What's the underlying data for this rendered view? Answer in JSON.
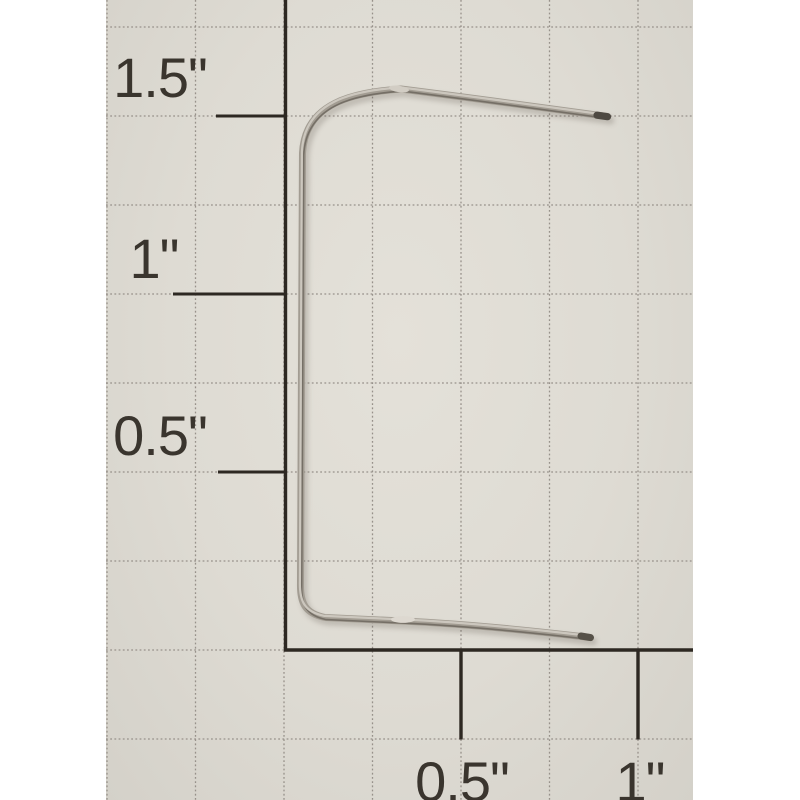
{
  "photo": {
    "subject": "metal-wire-clip",
    "paper_color": "#dedbd3",
    "grid_line_color": "#97918a",
    "axis_line_color": "#2d2822",
    "label_color": "#3a352e",
    "wire_body_color": "#a29c92",
    "wire_highlight_color": "#cdc8bf",
    "wire_tip_color": "#4e4942",
    "margin_color": "#ffffff"
  },
  "ruler": {
    "left_labels": [
      {
        "text": "1.5\""
      },
      {
        "text": "1\""
      },
      {
        "text": "0.5\""
      }
    ],
    "bottom_labels": [
      {
        "text": "0.5\""
      },
      {
        "text": "1\""
      }
    ]
  }
}
